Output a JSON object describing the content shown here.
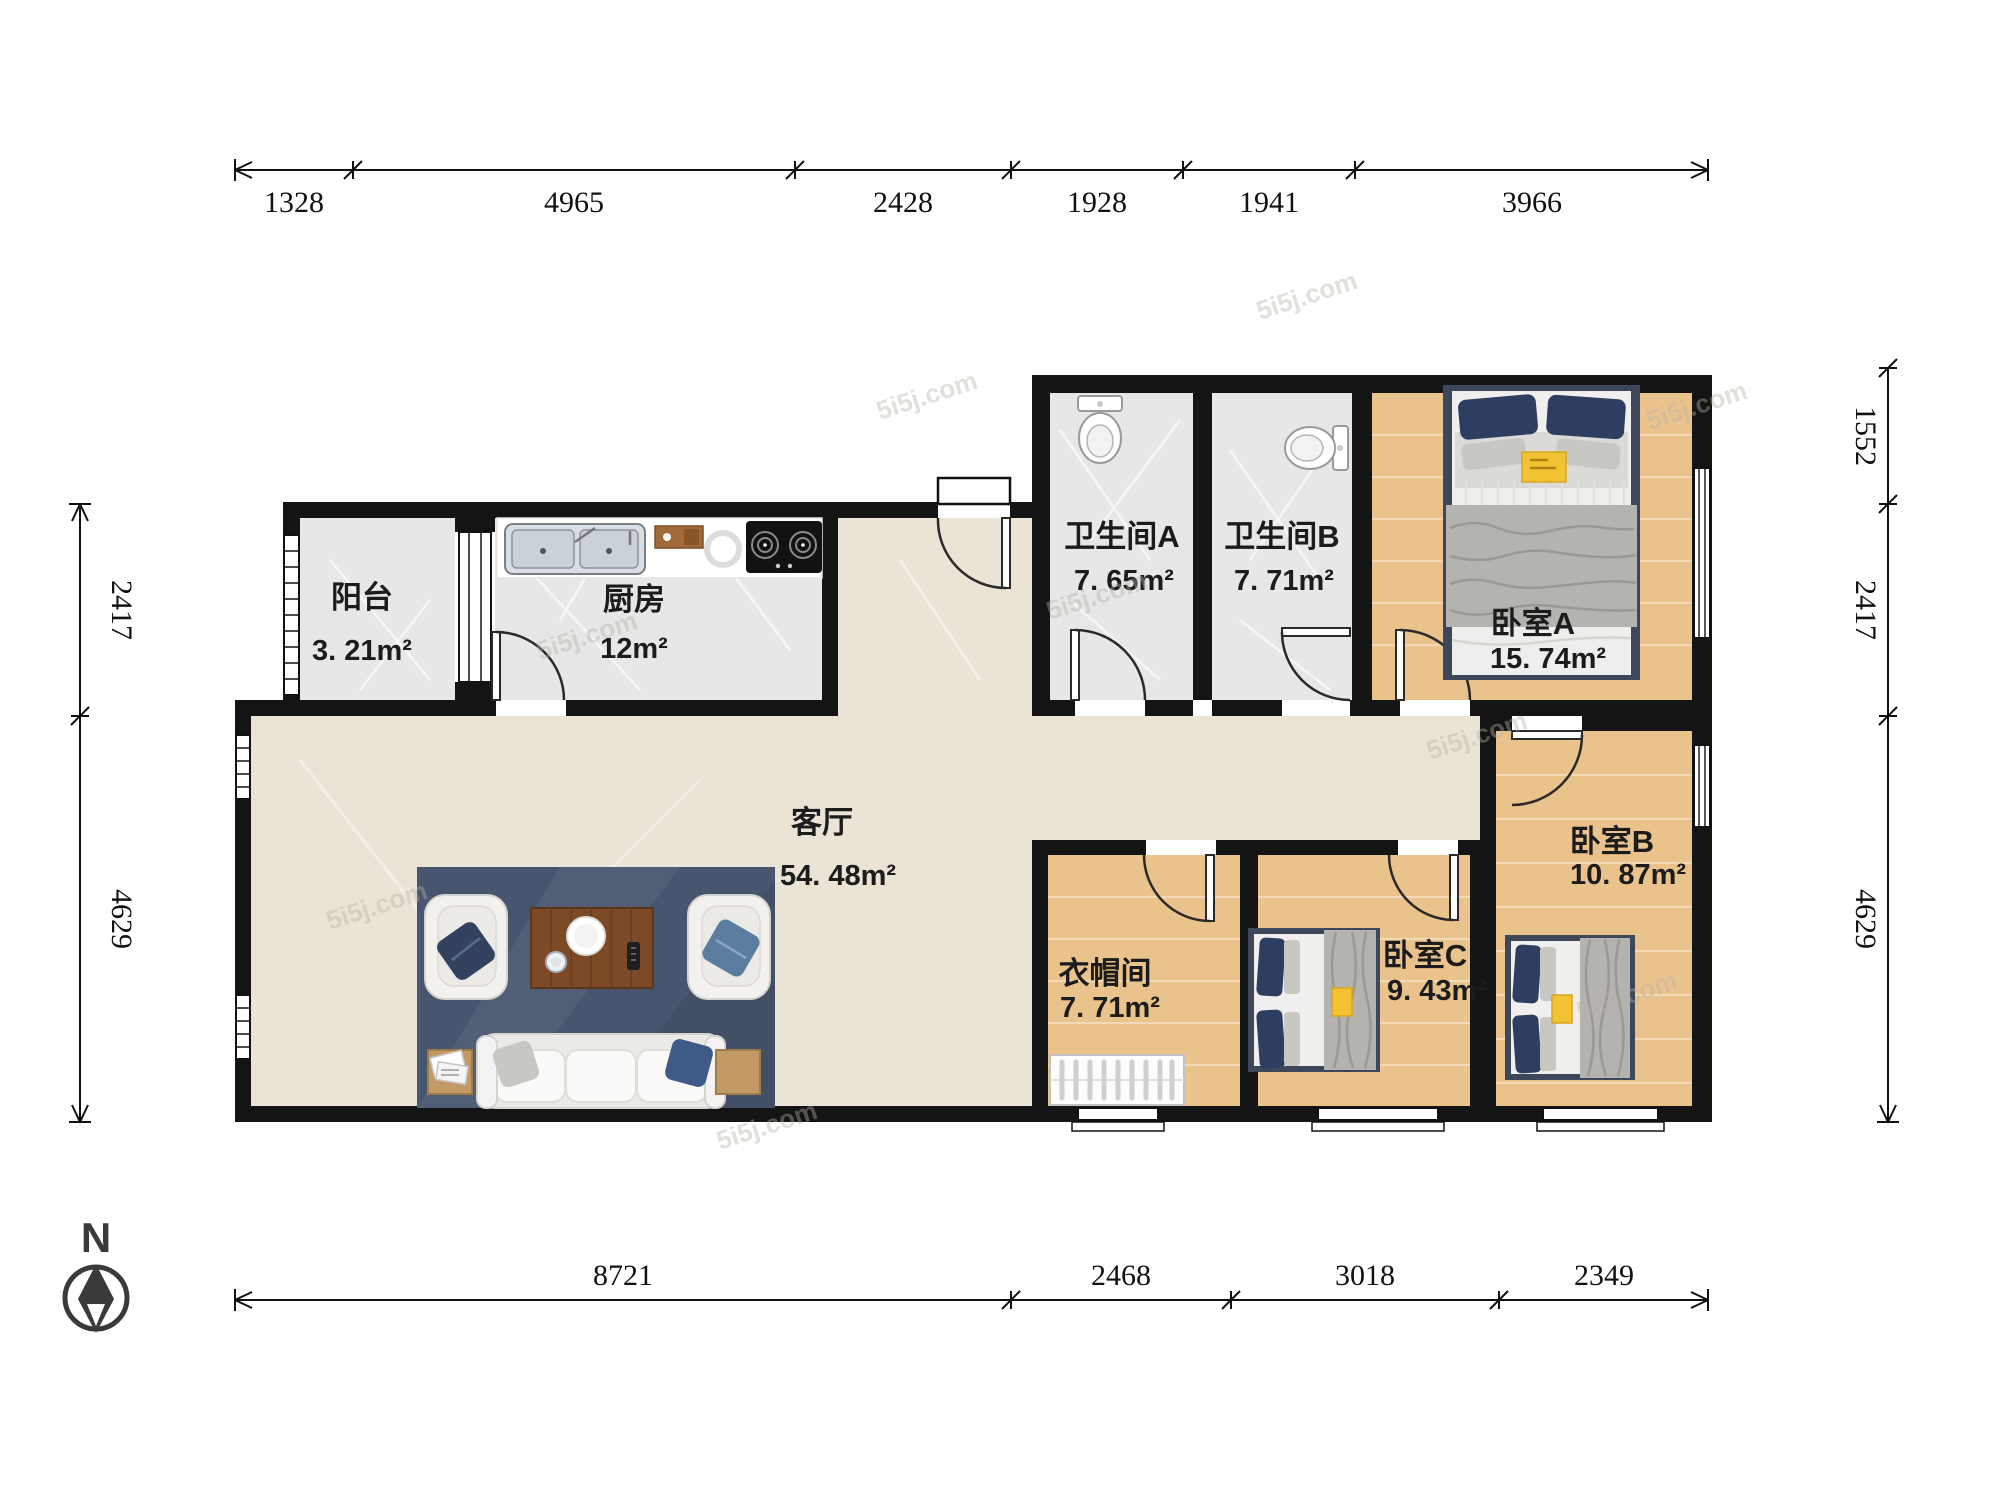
{
  "watermark": "5i5j.com",
  "compass": {
    "label": "N"
  },
  "dimensions": {
    "top": [
      "1328",
      "4965",
      "2428",
      "1928",
      "1941",
      "3966"
    ],
    "bottom": [
      "8721",
      "2468",
      "3018",
      "2349"
    ],
    "left": [
      "2417",
      "4629"
    ],
    "right": [
      "1552",
      "2417",
      "4629"
    ]
  },
  "rooms": {
    "balcony": {
      "name": "阳台",
      "area": "3. 21m²"
    },
    "kitchen": {
      "name": "厨房",
      "area": "12m²"
    },
    "living": {
      "name": "客厅",
      "area": "54. 48m²"
    },
    "bath_a": {
      "name": "卫生间A",
      "area": "7. 65m²"
    },
    "bath_b": {
      "name": "卫生间B",
      "area": "7. 71m²"
    },
    "bed_a": {
      "name": "卧室A",
      "area": "15. 74m²"
    },
    "bed_b": {
      "name": "卧室B",
      "area": "10. 87m²"
    },
    "closet": {
      "name": "衣帽间",
      "area": "7. 71m²"
    },
    "bed_c": {
      "name": "卧室C",
      "area": "9. 43m²"
    }
  }
}
